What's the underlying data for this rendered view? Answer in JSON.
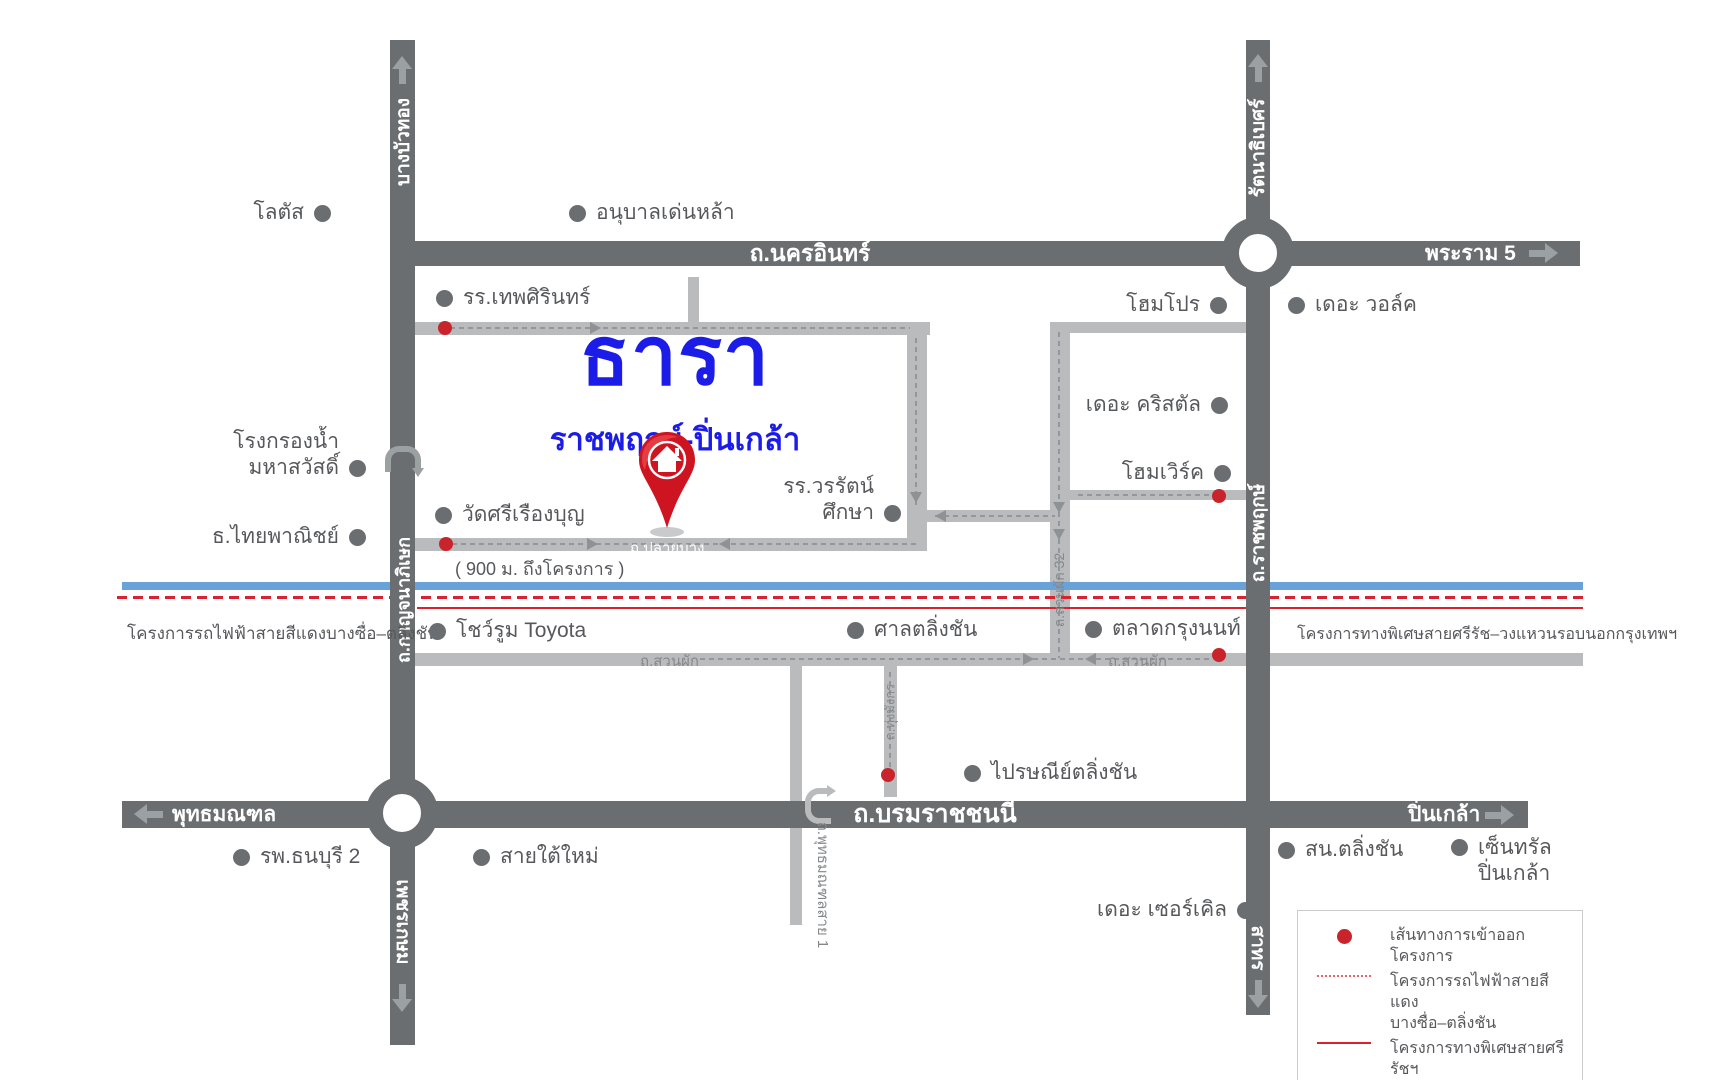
{
  "colors": {
    "road_dark": "#6b6e71",
    "road_light": "#b9bbbd",
    "text_gray": "#57585b",
    "logo_blue": "#1c1ce8",
    "access_red": "#c9242b",
    "rail_blue": "#68a2d8",
    "line_red": "#d8232e"
  },
  "project": {
    "name": "ธารา",
    "subtitle": "ราชพฤกษ์-ปิ่นเกล้า",
    "distance_note": "( 900 ม. ถึงโครงการ )",
    "pin_icon": "red-house-map-pin"
  },
  "roads": {
    "kanchanaphisek": {
      "label": "ถ.กาญจนาภิเษก",
      "dest_top": "บางบัวทอง",
      "dest_bottom": "เพชรเกษม"
    },
    "nakhon_in": {
      "label": "ถ.นครอินทร์",
      "dest_right": "พระราม 5"
    },
    "ratchaphruek": {
      "label": "ถ.ราชพฤกษ์",
      "dest_top": "รัตนาธิเบศร์",
      "dest_bottom": "สาทร"
    },
    "borommaratchachonnani": {
      "label": "ถ.บรมราชชนนี",
      "dest_left": "พุทธมณฑล",
      "dest_right": "ปิ่นเกล้า"
    },
    "plai_bang": {
      "label": "ถ.ปลายบาง"
    },
    "suan_phak_west": {
      "label": "ถ.สวนผัก"
    },
    "suan_phak_east": {
      "label": "ถ.สวนผัก"
    },
    "suan_phak_32": {
      "label": "ถ.สวนผัก 32"
    },
    "thung_mangkon": {
      "label": "ถ.ทุ่งมังกร"
    },
    "phutthamonthon_sai_1": {
      "label": "ถ.พุทธมณฑลสาย 1"
    }
  },
  "transit_notes": {
    "red_rail_left": "โครงการรถไฟฟ้าสายสีแดงบางซื่อ–ตลิ่งชัน",
    "expressway_right": "โครงการทางพิเศษสายศรีรัช–วงแหวนรอบนอกกรุงเทพฯ"
  },
  "landmarks": [
    {
      "label": "โลตัส",
      "x": 322,
      "top": 200,
      "side": "after",
      "va": "c"
    },
    {
      "label": "อนุบาลเด่นหล้า",
      "x": 578,
      "top": 200,
      "side": "before",
      "va": "c"
    },
    {
      "label": "รร.เทพศิรินทร์",
      "x": 445,
      "top": 285,
      "side": "before",
      "va": "c"
    },
    {
      "label": "โฮมโปร",
      "x": 1218,
      "top": 292,
      "side": "after",
      "va": "c"
    },
    {
      "label": "เดอะ วอล์ค",
      "x": 1297,
      "top": 292,
      "side": "before",
      "va": "c"
    },
    {
      "label": "เดอะ คริสตัล",
      "x": 1219,
      "top": 392,
      "side": "after",
      "va": "c"
    },
    {
      "label": "โฮมเวิร์ค",
      "x": 1222,
      "top": 460,
      "side": "after",
      "va": "c"
    },
    {
      "label": "รร.วรรัตน์\nศึกษา",
      "x": 892,
      "top": 474,
      "side": "after",
      "va": "e"
    },
    {
      "label": "โรงกรองน้ำ\nมหาสวัสดิ์",
      "x": 357,
      "top": 429,
      "side": "after",
      "va": "e"
    },
    {
      "label": "วัดศรีเรืองบุญ",
      "x": 444,
      "top": 502,
      "side": "before",
      "va": "c"
    },
    {
      "label": "ธ.ไทยพาณิชย์",
      "x": 357,
      "top": 524,
      "side": "after",
      "va": "c"
    },
    {
      "label": "โชว์รูม Toyota",
      "x": 438,
      "top": 618,
      "side": "before",
      "va": "c"
    },
    {
      "label": "ศาลตลิ่งชัน",
      "x": 856,
      "top": 617,
      "side": "before",
      "va": "c"
    },
    {
      "label": "ตลาดกรุงนนท์",
      "x": 1094,
      "top": 616,
      "side": "before",
      "va": "c"
    },
    {
      "label": "ไปรษณีย์ตลิ่งชัน",
      "x": 973,
      "top": 760,
      "side": "before",
      "va": "c"
    },
    {
      "label": "รพ.ธนบุรี 2",
      "x": 242,
      "top": 844,
      "side": "before",
      "va": "c"
    },
    {
      "label": "สายใต้ใหม่",
      "x": 482,
      "top": 844,
      "side": "before",
      "va": "c"
    },
    {
      "label": "เดอะ เซอร์เคิล",
      "x": 1245,
      "top": 897,
      "side": "after",
      "va": "c"
    },
    {
      "label": "สน.ตลิ่งชัน",
      "x": 1287,
      "top": 837,
      "side": "before",
      "va": "c"
    },
    {
      "label": "เซ็นทรัล\nปิ่นเกล้า",
      "x": 1460,
      "top": 835,
      "side": "before",
      "va": "s"
    }
  ],
  "access_points": [
    {
      "x": 445,
      "y": 328
    },
    {
      "x": 446,
      "y": 544
    },
    {
      "x": 1219,
      "y": 496
    },
    {
      "x": 1219,
      "y": 655
    },
    {
      "x": 888,
      "y": 775
    }
  ],
  "route_arrows": [
    {
      "d": "r",
      "x": 595,
      "y": 328
    },
    {
      "d": "r",
      "x": 592,
      "y": 544
    },
    {
      "d": "l",
      "x": 724,
      "y": 544
    },
    {
      "d": "l",
      "x": 940,
      "y": 516
    },
    {
      "d": "d",
      "x": 916,
      "y": 497
    },
    {
      "d": "d",
      "x": 1059,
      "y": 507
    },
    {
      "d": "d",
      "x": 1059,
      "y": 534
    },
    {
      "d": "r",
      "x": 1028,
      "y": 659
    },
    {
      "d": "l",
      "x": 1090,
      "y": 659
    }
  ],
  "legend": {
    "items": [
      {
        "symbol": "red-dot",
        "label": "เส้นทางการเข้าออกโครงการ"
      },
      {
        "symbol": "red-dashed-line",
        "label": "โครงการรถไฟฟ้าสายสีแดง\nบางซื่อ–ตลิ่งชัน"
      },
      {
        "symbol": "red-solid-line",
        "label": "โครงการทางพิเศษสายศรีรัชฯ"
      }
    ]
  }
}
